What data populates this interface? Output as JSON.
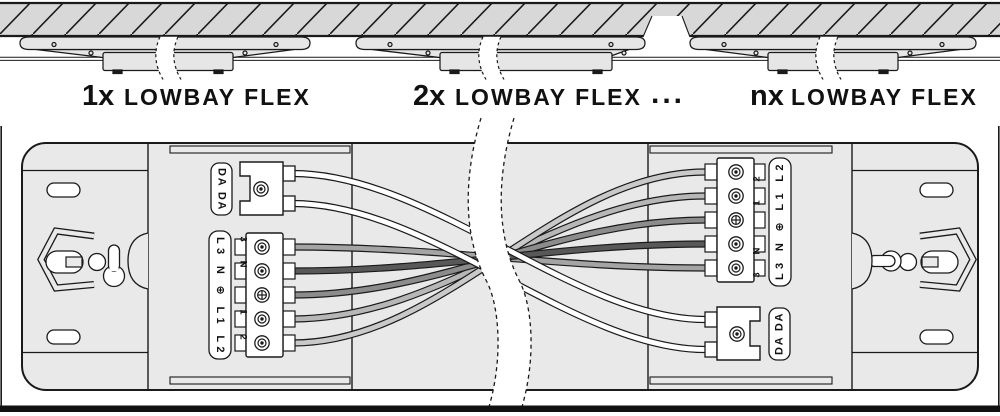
{
  "header": {
    "items": [
      {
        "qty": "1x",
        "product": "LOWBAY FLEX"
      },
      {
        "qty": "2x",
        "product": "LOWBAY FLEX"
      },
      {
        "qty": "nx",
        "product": "LOWBAY FLEX"
      }
    ],
    "ellipsis": "..."
  },
  "diagram": {
    "left_module": {
      "dali_plate": "DA DA",
      "power_plate": "L3 N ⊕ L1 L2",
      "terminals": {
        "t3": "3",
        "tN": "N",
        "t1": "1",
        "t2": "2"
      }
    },
    "right_module": {
      "dali_plate": "DA DA",
      "power_plate": "L3 N ⊕ L1 L2",
      "terminals": {
        "t3": "3",
        "tN": "N",
        "t1": "1",
        "t2": "2"
      }
    },
    "wires": [
      {
        "id": "dali-a",
        "from": "DA",
        "to": "DA",
        "color": "#ffffff"
      },
      {
        "id": "dali-b",
        "from": "DA",
        "to": "DA",
        "color": "#ffffff"
      },
      {
        "id": "l3",
        "from": "3",
        "to": "3",
        "color": "#a4a4a4"
      },
      {
        "id": "n",
        "from": "N",
        "to": "N",
        "color": "#585858"
      },
      {
        "id": "pe",
        "from": "⊕",
        "to": "⊕",
        "color": "#8c8c8c"
      },
      {
        "id": "l1",
        "from": "1",
        "to": "1",
        "color": "#b7b7b7"
      },
      {
        "id": "l2",
        "from": "2",
        "to": "2",
        "color": "#c9c9c9"
      }
    ]
  },
  "colors": {
    "ceiling": "#d8d8d8",
    "fixture": "#e6e6e6",
    "body": "#e9e9e9",
    "outline": "#1a1a1a"
  }
}
